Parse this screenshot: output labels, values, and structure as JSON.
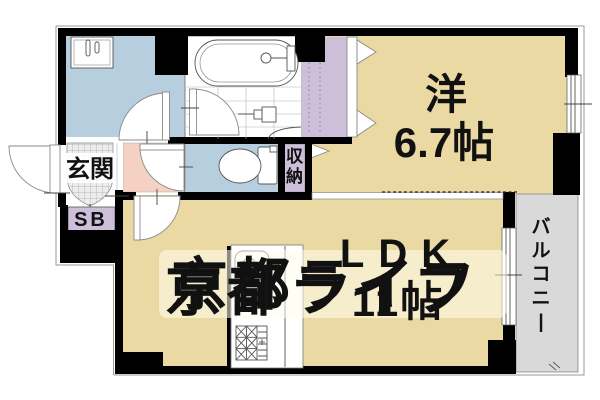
{
  "plan": {
    "rooms": [
      {
        "id": "western",
        "label": "洋",
        "size": "6.7帖"
      },
      {
        "id": "ldk",
        "label": "LDK",
        "size": "11帖"
      },
      {
        "id": "entrance",
        "label": "玄関"
      },
      {
        "id": "shoe_box",
        "label": "SB"
      },
      {
        "id": "storage",
        "label": "収納"
      },
      {
        "id": "balcony",
        "label": "バルコニー"
      }
    ]
  },
  "watermark": {
    "text": "京都ライフ"
  },
  "colors": {
    "room_beige": "#EBD9A3",
    "water_blue": "#B7CEDF",
    "closet_lavender": "#CDBFDA",
    "hall_pink": "#F5D1C3",
    "balcony_gray": "#D9D9D9",
    "wall_black": "#000000",
    "watermark_gold": "#E0C878"
  }
}
